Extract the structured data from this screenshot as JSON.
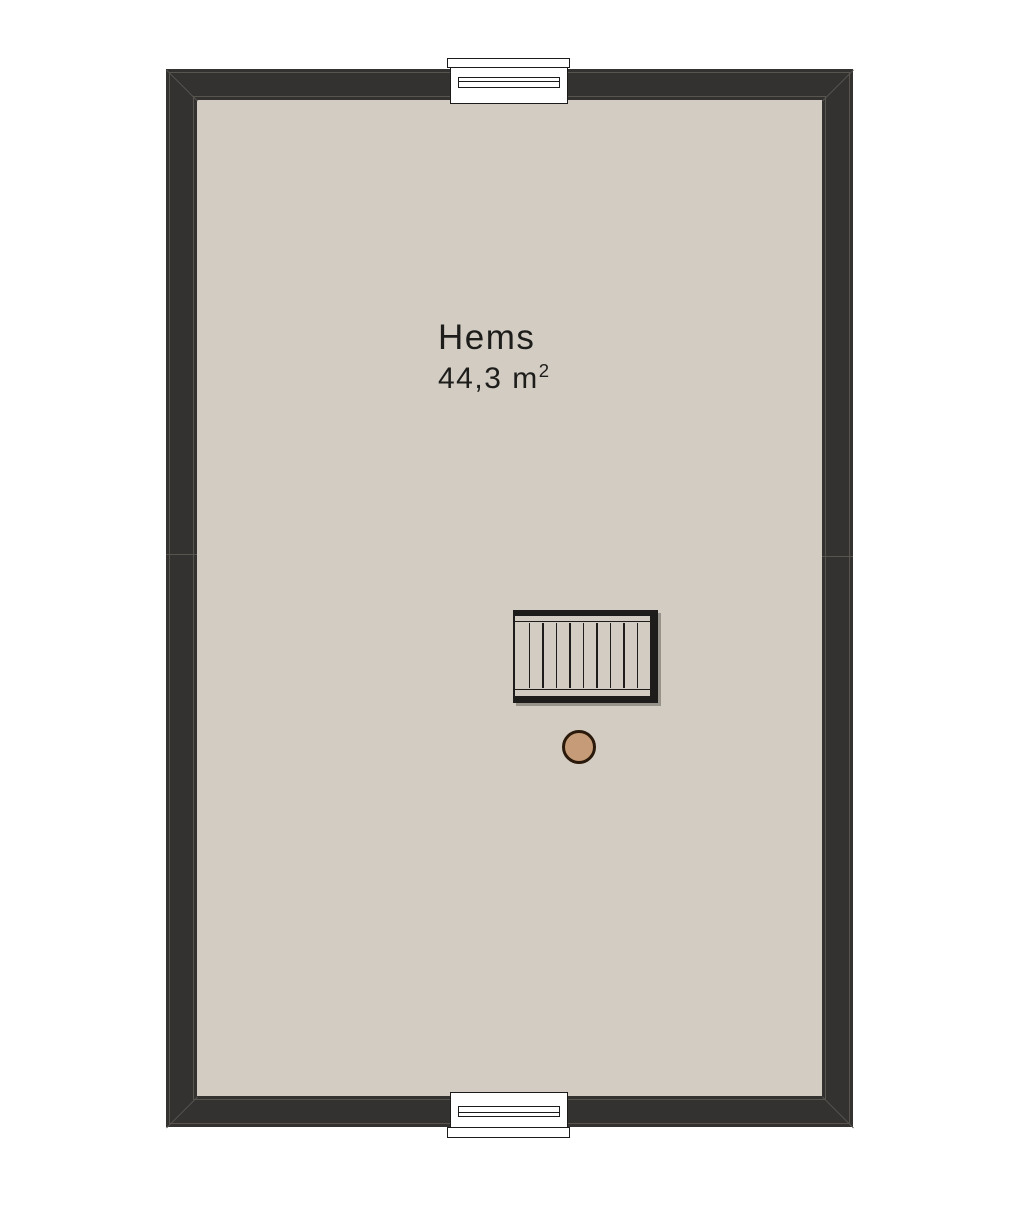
{
  "room": {
    "name": "Hems",
    "area": "44,3 m",
    "area_exponent": "2"
  },
  "stair": {
    "tread_count": 10
  },
  "features": {
    "windows": [
      "top",
      "bottom"
    ],
    "post": "round-newel-post"
  },
  "colors": {
    "background": "#ffffff",
    "wall": "#343231",
    "wall_line": "#57554e",
    "floor": "#d3ccc2",
    "outline": "#1c1b19",
    "window_fill": "#ffffff",
    "stair_line": "#1e1d1b",
    "post_fill": "#c59c77",
    "post_stroke": "#2b1a0b",
    "text": "#1d1d1b"
  }
}
